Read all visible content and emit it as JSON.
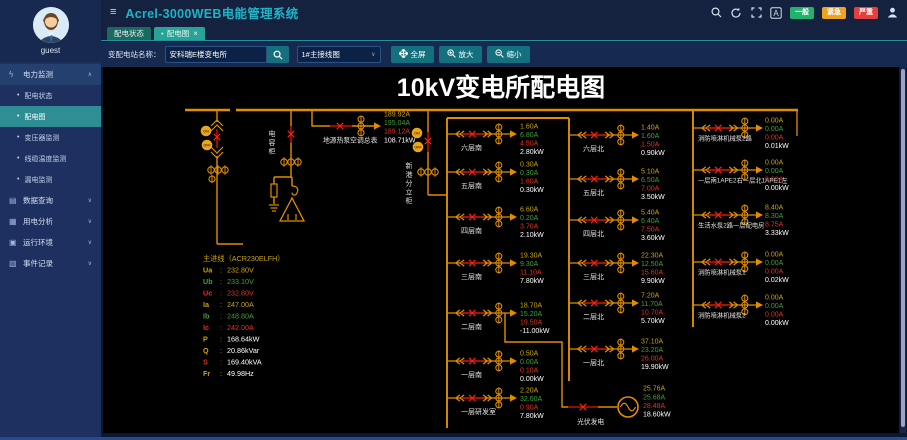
{
  "header": {
    "title": "Acrel-3000WEB电能管理系统",
    "font_icon_label": "A",
    "alarm_badges": [
      {
        "label": "一般",
        "color": "#21b36b"
      },
      {
        "label": "紧急",
        "color": "#f2a31d"
      },
      {
        "label": "严重",
        "color": "#e2403c"
      }
    ]
  },
  "sidebar": {
    "user": "guest",
    "menu": [
      {
        "type": "parent",
        "icon": "ϟ",
        "label": "电力监测",
        "expanded": true
      },
      {
        "type": "child",
        "label": "配电状态",
        "active": false
      },
      {
        "type": "child",
        "label": "配电图",
        "active": true
      },
      {
        "type": "child",
        "label": "变压器监测",
        "active": false
      },
      {
        "type": "child",
        "label": "线缆温度监测",
        "active": false
      },
      {
        "type": "child",
        "label": "漏电监测",
        "active": false
      },
      {
        "type": "parent",
        "icon": "▤",
        "label": "数据查询",
        "expanded": false
      },
      {
        "type": "parent",
        "icon": "▦",
        "label": "用电分析",
        "expanded": false
      },
      {
        "type": "parent",
        "icon": "▣",
        "label": "运行环境",
        "expanded": false
      },
      {
        "type": "parent",
        "icon": "▧",
        "label": "事件记录",
        "expanded": false
      }
    ]
  },
  "tabs": [
    {
      "label": "配电状态",
      "active": false,
      "dot": false,
      "closable": false
    },
    {
      "label": "配电图",
      "active": true,
      "dot": true,
      "closable": true
    }
  ],
  "toolbar": {
    "station_label": "变配电站名称：",
    "station_value": "安科瑞E楼变电所",
    "diagram_value": "1#主接线图",
    "buttons": [
      {
        "label": "全屏",
        "icon": "expand"
      },
      {
        "label": "放大",
        "icon": "zoom-in"
      },
      {
        "label": "缩小",
        "icon": "zoom-out"
      }
    ]
  },
  "glyphs": {
    "dot": "●",
    "close": "×",
    "bullet": "•",
    "chevron_up": "∧",
    "chevron_down": "∨",
    "hamburger": "≡"
  },
  "diagram": {
    "title": "10kV变电所配电图",
    "line_color": "#e08e00",
    "phase_colors": [
      "#c9a40a",
      "#3fa03a",
      "#e23222",
      "#ffffff"
    ],
    "on_off": [
      "ON",
      "OFF"
    ],
    "capacitor_label": "电容柜",
    "incoming_cabinet_label": "新港分立柜",
    "heat_pump": {
      "label": "地源热泵空调总表",
      "values": [
        "189.92A",
        "195.04A",
        "189.12A",
        "108.71kW"
      ]
    },
    "pv": {
      "label": "光伏发电",
      "values": [
        "25.76A",
        "25.68A",
        "28.48A",
        "18.60kW"
      ]
    },
    "measurements": {
      "title": "主进线（ACR230ELFH）",
      "rows": [
        {
          "label": "Ua",
          "value": "232.80V",
          "color": 0,
          "white": false
        },
        {
          "label": "Ub",
          "value": "233.10V",
          "color": 1,
          "white": false
        },
        {
          "label": "Uc",
          "value": "232.80V",
          "color": 2,
          "white": false
        },
        {
          "label": "Ia",
          "value": "247.00A",
          "color": 0,
          "white": false
        },
        {
          "label": "Ib",
          "value": "248.80A",
          "color": 1,
          "white": false
        },
        {
          "label": "Ic",
          "value": "242.00A",
          "color": 2,
          "white": false
        },
        {
          "label": "P",
          "value": "168.64kW",
          "color": 0,
          "white": true
        },
        {
          "label": "Q",
          "value": "20.86kVar",
          "color": 0,
          "white": true
        },
        {
          "label": "S",
          "value": "169.40kVA",
          "color": 2,
          "white": true
        },
        {
          "label": "Fr",
          "value": "49.98Hz",
          "color": 0,
          "white": true
        }
      ]
    },
    "columns": [
      {
        "id": "south",
        "bus_x": 447,
        "bus_y1": 118,
        "bus_y2": 428,
        "value_x": 520,
        "branches": [
          {
            "label": "六层南",
            "y": 134,
            "values": [
              "1.60A",
              "6.80A",
              "4.50A",
              "2.80kW"
            ]
          },
          {
            "label": "五层南",
            "y": 172,
            "values": [
              "0.30A",
              "0.30A",
              "1.60A",
              "0.30kW"
            ]
          },
          {
            "label": "四层南",
            "y": 217,
            "values": [
              "6.60A",
              "0.20A",
              "3.70A",
              "2.10kW"
            ]
          },
          {
            "label": "三层南",
            "y": 263,
            "values": [
              "19.30A",
              "9.30A",
              "11.10A",
              "7.80kW"
            ]
          },
          {
            "label": "二层南",
            "y": 313,
            "values": [
              "18.70A",
              "15.20A",
              "19.50A",
              "-11.00kW"
            ]
          },
          {
            "label": "一层南",
            "y": 361,
            "values": [
              "0.50A",
              "0.00A",
              "0.10A",
              "0.00kW"
            ]
          },
          {
            "label": "一层研发室",
            "y": 398,
            "values": [
              "2.20A",
              "32.60A",
              "0.90A",
              "7.80kW"
            ]
          }
        ]
      },
      {
        "id": "north",
        "bus_x": 569,
        "bus_y1": 118,
        "bus_y2": 381,
        "value_x": 641,
        "branches": [
          {
            "label": "六层北",
            "y": 135,
            "values": [
              "1.40A",
              "1.60A",
              "1.50A",
              "0.90kW"
            ]
          },
          {
            "label": "五层北",
            "y": 179,
            "values": [
              "5.10A",
              "6.50A",
              "7.00A",
              "3.50kW"
            ]
          },
          {
            "label": "四层北",
            "y": 220,
            "values": [
              "5.40A",
              "6.40A",
              "7.50A",
              "3.60kW"
            ]
          },
          {
            "label": "三层北",
            "y": 263,
            "values": [
              "22.30A",
              "12.50A",
              "15.60A",
              "9.90kW"
            ]
          },
          {
            "label": "二层北",
            "y": 303,
            "values": [
              "7.20A",
              "11.70A",
              "10.70A",
              "5.70kW"
            ]
          },
          {
            "label": "一层北",
            "y": 349,
            "values": [
              "37.10A",
              "23.20A",
              "26.00A",
              "19.90kW"
            ]
          }
        ]
      },
      {
        "id": "pumps",
        "bus_x": 693,
        "bus_y1": 110,
        "bus_y2": 327,
        "value_x": 765,
        "branches": [
          {
            "label": "消防喷淋机械泵2路",
            "y": 128,
            "values": [
              "0.00A",
              "0.00A",
              "0.00A",
              "0.01kW"
            ]
          },
          {
            "label": "一层南1APE2右一层北1APE1左",
            "y": 170,
            "values": [
              "0.00A",
              "0.00A",
              "0.00A",
              "0.00kW"
            ]
          },
          {
            "label": "生活水泵2路一层配电房",
            "y": 215,
            "values": [
              "8.40A",
              "8.30A",
              "8.75A",
              "3.33kW"
            ]
          },
          {
            "label": "消防喷淋机械泵1",
            "y": 262,
            "values": [
              "0.00A",
              "0.00A",
              "0.00A",
              "0.02kW"
            ]
          },
          {
            "label": "消防喷淋机械泵2",
            "y": 305,
            "values": [
              "0.00A",
              "0.00A",
              "0.00A",
              "0.00kW"
            ]
          }
        ]
      }
    ]
  }
}
